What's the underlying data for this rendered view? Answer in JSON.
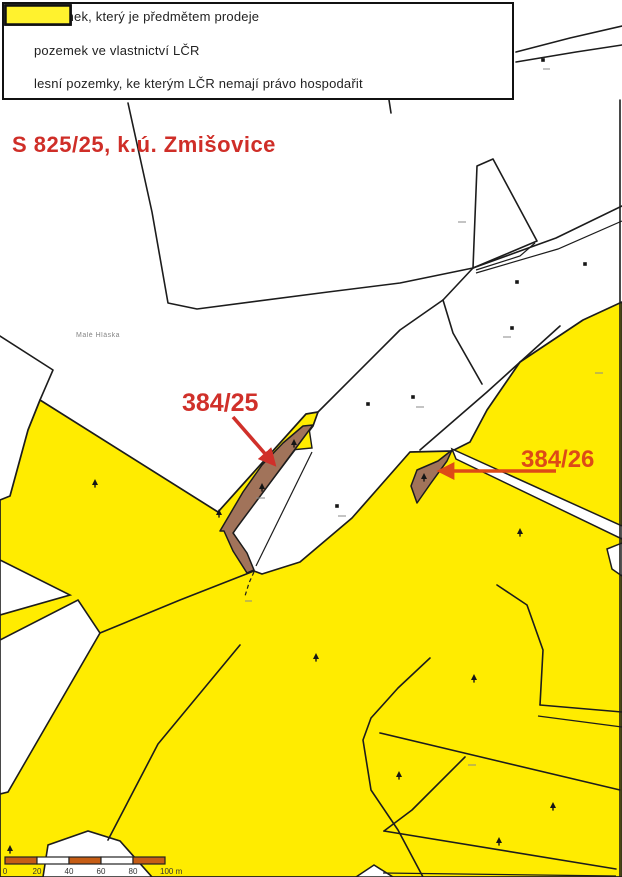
{
  "legend": {
    "items": [
      {
        "label": "pozemek, který je předmětem prodeje",
        "swatch_color": "#a6765b"
      },
      {
        "label": "pozemek ve vlastnictví LČR",
        "swatch_color": "#95da2b"
      },
      {
        "label": "lesní pozemky, ke kterým LČR nemají právo hospodařit",
        "swatch_color": "#fff22e"
      }
    ]
  },
  "title": {
    "text": "S 825/25, k.ú. Zmišovice",
    "color": "#cf2e28"
  },
  "map": {
    "colors": {
      "background": "#ffffff",
      "forest_yellow": "#ffec00",
      "sale_brown": "#a1735a",
      "boundary_black": "#1c1c1c",
      "annotation_red": "#d0302a",
      "annotation_red_orange": "#dd4a17",
      "road_white": "#ffffff"
    },
    "parcel_labels": [
      {
        "text": "384/25"
      },
      {
        "text": "384/26"
      }
    ],
    "place_label": "Malé Hláska"
  },
  "scale_bar": {
    "tick_labels": [
      "0",
      "20",
      "40",
      "60",
      "80",
      "100 m"
    ],
    "segment_color": "#c65d15"
  },
  "icons": {
    "conifer": "conifer-tree",
    "deciduous": "deciduous-tree"
  }
}
